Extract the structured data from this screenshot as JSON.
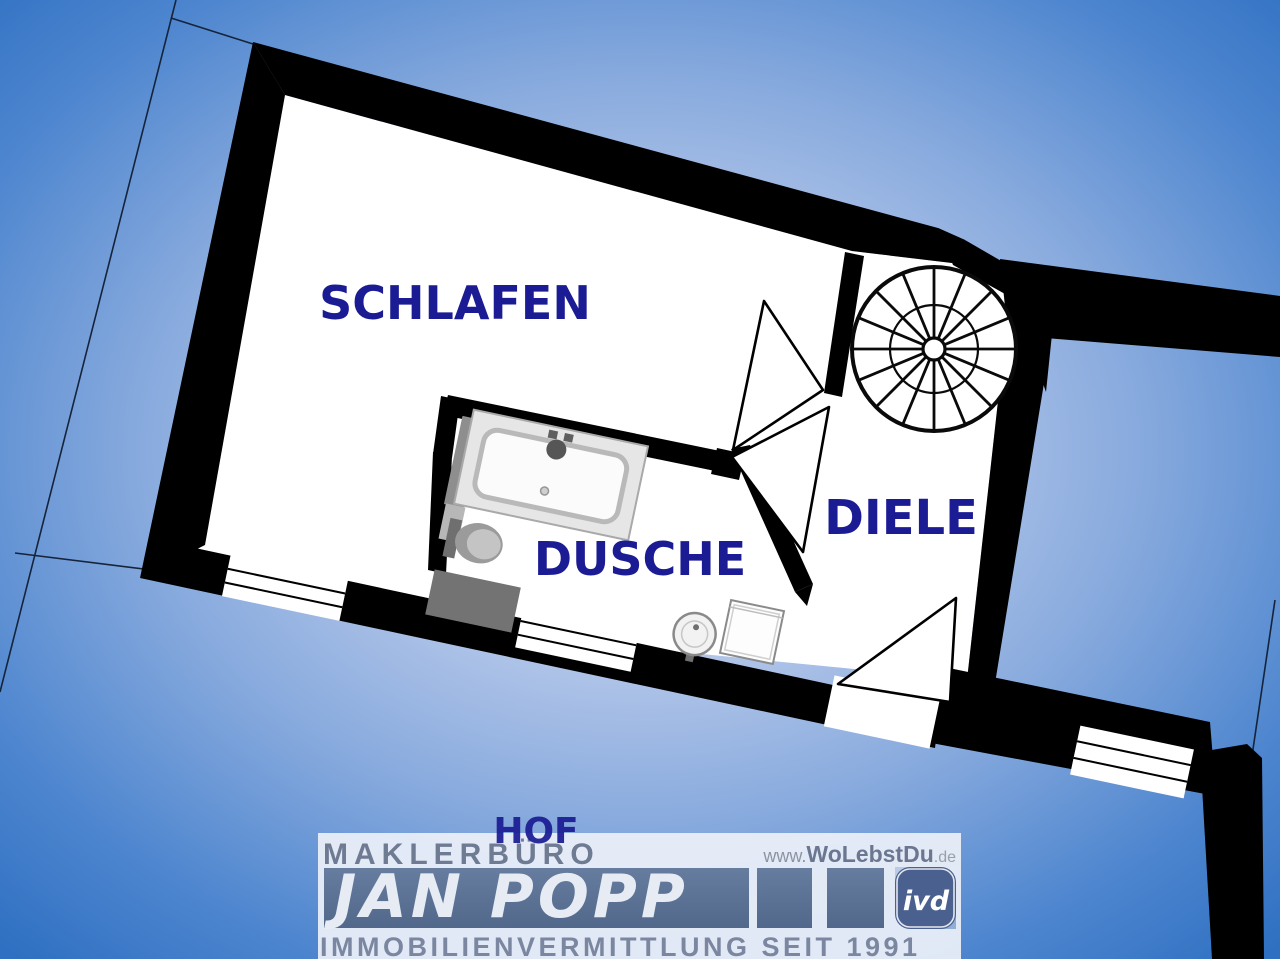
{
  "plan": {
    "labels": {
      "schlafen": "SCHLAFEN",
      "dusche": "DUSCHE",
      "diele": "DIELE",
      "hof": "HOF"
    }
  },
  "branding": {
    "office": "MAKLERBÜRO",
    "agent": "JAN POPP",
    "web_prefix": "www.",
    "web_name": "WoLebstDu",
    "web_tld": ".de",
    "tagline": "IMMOBILIENVERMITTLUNG SEIT 1991",
    "badge": "ivd"
  },
  "colors": {
    "label_navy": "#1b1b94",
    "hof_navy": "#3d3dae",
    "logo_slate": "#5b7294",
    "logo_text_gray": "#6e7b92",
    "wall_black": "#000000",
    "background_blue_edge": "#2f70c2",
    "background_blue_center": "#cdd9f0"
  }
}
